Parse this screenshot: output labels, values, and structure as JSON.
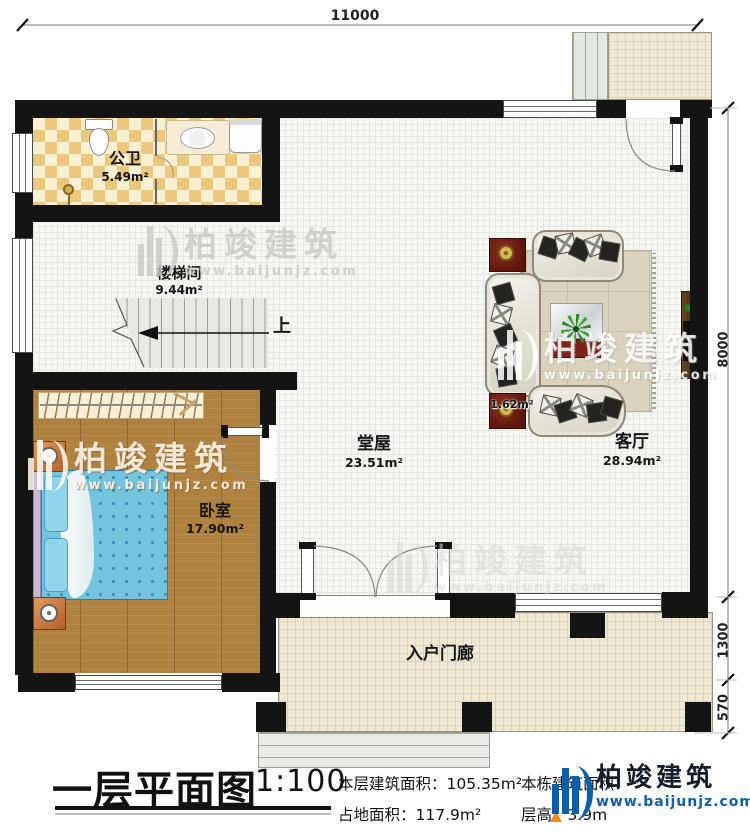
{
  "plan": {
    "dimensions": {
      "width_top": "11000",
      "height_right": "8000",
      "porch_depth": "1300",
      "steps_depth": "570"
    },
    "rooms": {
      "bathroom": {
        "name": "公卫",
        "area": "5.49m²"
      },
      "stairwell": {
        "name": "楼梯间",
        "area": "9.44m²"
      },
      "up_arrow": "上",
      "bedroom": {
        "name": "卧室",
        "area": "17.90m²"
      },
      "hall": {
        "name": "堂屋",
        "area": "23.51m²"
      },
      "living_room": {
        "name": "客厅",
        "area": "28.94m²"
      },
      "porch": {
        "name": "入户门廊"
      },
      "corner_area": "1.62m²"
    }
  },
  "title_block": {
    "title": "一层平面图",
    "scale": "1:100",
    "floor_area_label": "本层建筑面积：",
    "floor_area_value": "105.35m²",
    "land_area_label": "占地面积：",
    "land_area_value": "117.9m²",
    "building_area_label": "本栋建筑面积：",
    "storey_height_label": "层高：",
    "storey_height_value": "3.9m"
  },
  "watermark": {
    "brand": "柏竣建筑",
    "url": "www.baijunjz.com"
  },
  "logo": {
    "brand": "柏竣建筑",
    "url": "www.baijunjz.com"
  }
}
